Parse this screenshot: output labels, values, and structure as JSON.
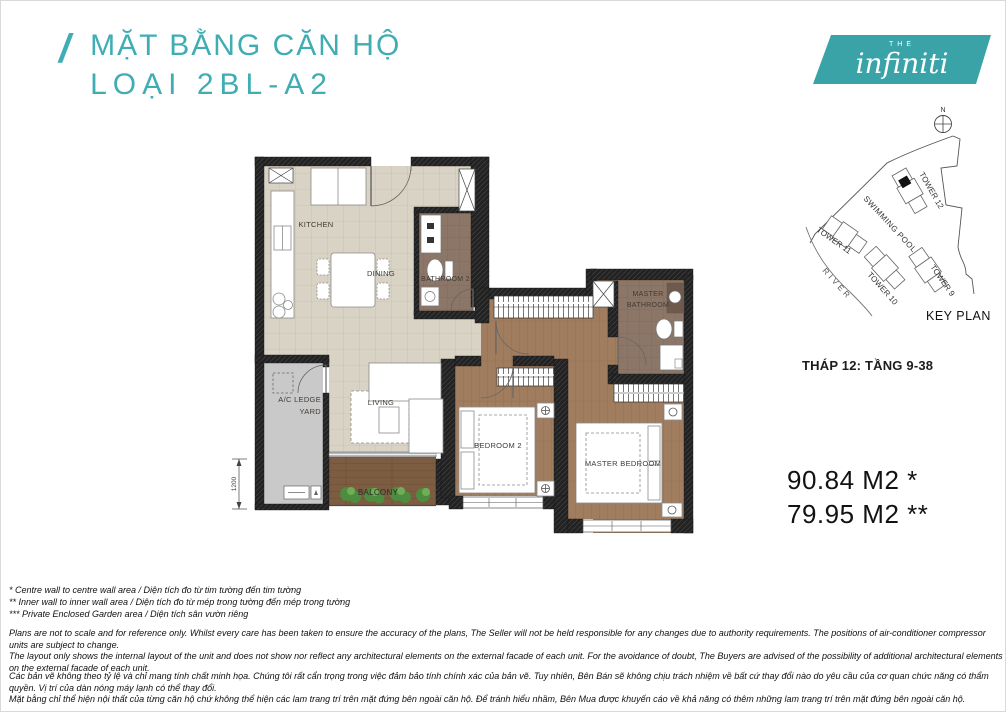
{
  "header": {
    "slash": "/",
    "title_line1": "MẶT BẰNG CĂN HỘ",
    "title_line2": "LOẠI 2BL-A2"
  },
  "logo": {
    "the": "THE",
    "name": "infiniti"
  },
  "keyplan": {
    "north_label": "N",
    "swimming_pool": "SWIMMING POOL",
    "tower12": "TOWER 12",
    "tower11": "TOWER 11",
    "tower10": "TOWER 10",
    "tower9": "TOWER 9",
    "river": "RIVER",
    "title": "KEY PLAN"
  },
  "unit": {
    "tower_floor": "THÁP 12: TẦNG 9-38",
    "area_line1": "90.84 M2 *",
    "area_line2": "79.95 M2 **"
  },
  "plan": {
    "rooms": {
      "kitchen": "KITCHEN",
      "dining": "DINING",
      "bathroom2": "BATHROOM 2",
      "master_bathroom_l1": "MASTER",
      "master_bathroom_l2": "BATHROOM",
      "living": "LIVING",
      "ac_ledge_l1": "A/C LEDGE",
      "ac_ledge_l2": "YARD",
      "bedroom2": "BEDROOM 2",
      "master_bedroom": "MASTER BEDROOM",
      "balcony": "BALCONY"
    },
    "dimension_left": "1200"
  },
  "footnotes": [
    "* Centre wall to centre wall area / Diện tích đo từ tim tường đến tim tường",
    "** Inner wall to inner wall area / Diện tích đo từ mép trong tường đến mép trong tường",
    "*** Private Enclosed Garden area / Diện tích sân vườn riêng"
  ],
  "disclaimer_en": [
    "Plans are not to scale and for reference only. Whilst every care has been taken to ensure the accuracy of the plans, The Seller will not be held responsible for any changes due to authority requirements. The positions of air-conditioner compressor units are subject to change.",
    "The layout only shows the internal layout of the unit and does not show nor reflect any architectural elements on the external facade of each unit. For the avoidance of doubt, The Buyers are advised of the possibility of additional architectural elements on the external facade of each unit."
  ],
  "disclaimer_vi": [
    "Các bản vẽ không theo tỷ lệ và chỉ mang tính chất minh họa. Chúng tôi rất cẩn trọng trong việc đảm bảo tính chính xác của bản vẽ. Tuy nhiên, Bên Bán sẽ không chịu trách nhiệm về bất cứ thay đổi nào do yêu cầu của cơ quan chức năng có thẩm quyền. Vị trí của dàn nóng máy lạnh có thể thay đổi.",
    "Mặt bằng chỉ thể hiện nội thất của từng căn hộ chứ không thể hiện các lam trang trí trên mặt đứng bên ngoài căn hộ. Để tránh hiểu nhầm, Bên Mua được khuyến cáo về khả năng có thêm những lam trang trí trên mặt đứng bên ngoài căn hộ."
  ],
  "colors": {
    "accent": "#3fadb3",
    "logo_teal": "#3aa3a8"
  }
}
